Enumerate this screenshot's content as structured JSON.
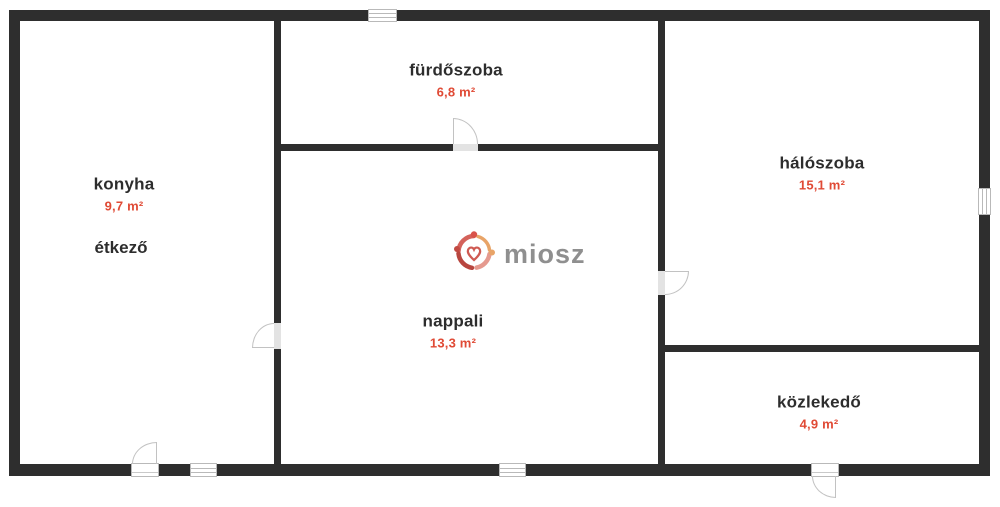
{
  "title": "floor-plan",
  "rooms": [
    {
      "id": "konyha",
      "label": "konyha",
      "area": "9,7 m²",
      "sublabel": "étkező"
    },
    {
      "id": "furdoszoba",
      "label": "fürdőszoba",
      "area": "6,8 m²"
    },
    {
      "id": "nappali",
      "label": "nappali",
      "area": "13,3 m²"
    },
    {
      "id": "haloszoba",
      "label": "hálószoba",
      "area": "15,1 m²"
    },
    {
      "id": "kozlekedo",
      "label": "közlekedő",
      "area": "4,9 m²"
    }
  ],
  "logo": {
    "text": "miosz"
  },
  "colors": {
    "wall": "#2e2e2e",
    "room_label": "#2d2d2d",
    "area_text": "#e04a35",
    "logo_text": "#8f8f8f",
    "door_window_stroke": "#c2c2c2"
  }
}
